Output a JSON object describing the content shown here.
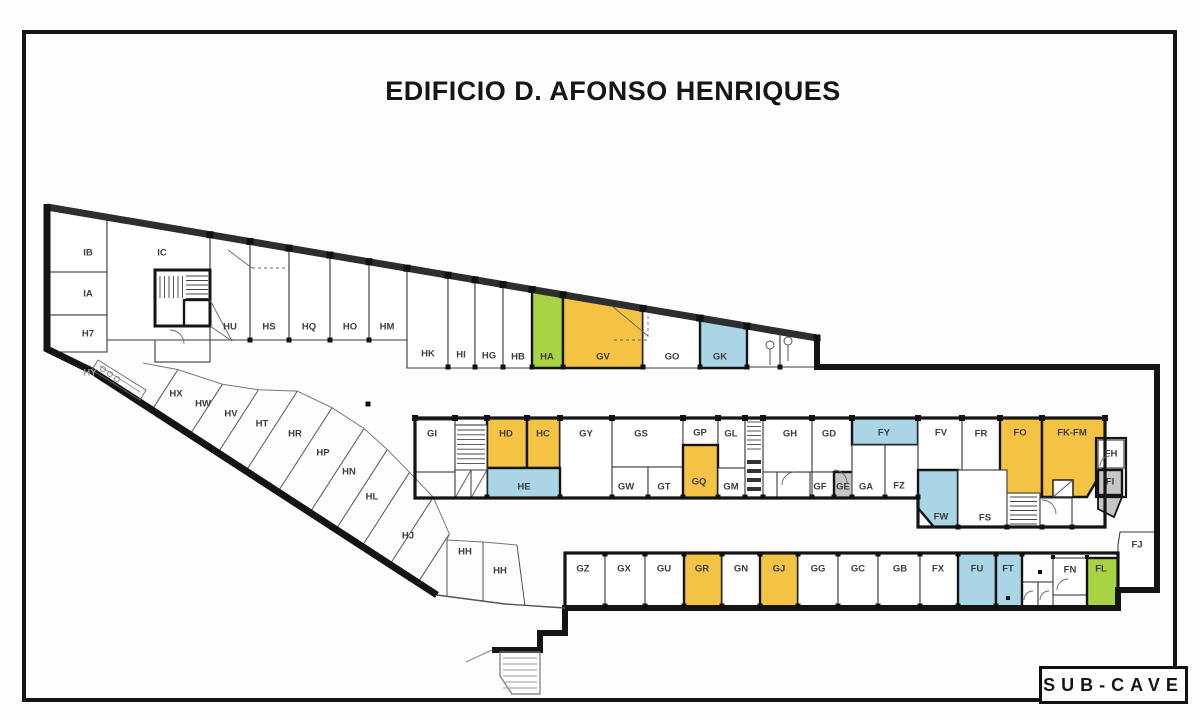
{
  "title": "EDIFICIO D. AFONSO HENRIQUES",
  "floor_label": "SUB-CAVE",
  "colors": {
    "orange": "#F4C343",
    "blue": "#A9D5E6",
    "green": "#A8D343",
    "gray": "#C6C6C6",
    "white": "#FFFFFF",
    "wall": "#151515"
  },
  "rooms": [
    {
      "id": "IB",
      "label": "IB",
      "color": "white"
    },
    {
      "id": "IA",
      "label": "IA",
      "color": "white"
    },
    {
      "id": "H7",
      "label": "H7",
      "color": "white"
    },
    {
      "id": "HY",
      "label": "HY",
      "color": "white"
    },
    {
      "id": "IC",
      "label": "IC",
      "color": "white"
    },
    {
      "id": "HU",
      "label": "HU",
      "color": "white"
    },
    {
      "id": "HS",
      "label": "HS",
      "color": "white"
    },
    {
      "id": "HQ",
      "label": "HQ",
      "color": "white"
    },
    {
      "id": "HO",
      "label": "HO",
      "color": "white"
    },
    {
      "id": "HM",
      "label": "HM",
      "color": "white"
    },
    {
      "id": "HK",
      "label": "HK",
      "color": "white"
    },
    {
      "id": "HI",
      "label": "HI",
      "color": "white"
    },
    {
      "id": "HG",
      "label": "HG",
      "color": "white"
    },
    {
      "id": "HB",
      "label": "HB",
      "color": "white"
    },
    {
      "id": "HA",
      "label": "HA",
      "color": "green"
    },
    {
      "id": "GV",
      "label": "GV",
      "color": "orange"
    },
    {
      "id": "GO",
      "label": "GO",
      "color": "white"
    },
    {
      "id": "GK",
      "label": "GK",
      "color": "blue"
    },
    {
      "id": "HX",
      "label": "HX",
      "color": "white"
    },
    {
      "id": "HW",
      "label": "HW",
      "color": "white"
    },
    {
      "id": "HV",
      "label": "HV",
      "color": "white"
    },
    {
      "id": "HT",
      "label": "HT",
      "color": "white"
    },
    {
      "id": "HR",
      "label": "HR",
      "color": "white"
    },
    {
      "id": "HP",
      "label": "HP",
      "color": "white"
    },
    {
      "id": "HN",
      "label": "HN",
      "color": "white"
    },
    {
      "id": "HL",
      "label": "HL",
      "color": "white"
    },
    {
      "id": "HJ",
      "label": "HJ",
      "color": "white"
    },
    {
      "id": "HH-1",
      "label": "HH",
      "color": "white"
    },
    {
      "id": "HH-2",
      "label": "HH",
      "color": "white"
    },
    {
      "id": "GI",
      "label": "GI",
      "color": "white"
    },
    {
      "id": "HD",
      "label": "HD",
      "color": "orange"
    },
    {
      "id": "HC",
      "label": "HC",
      "color": "orange"
    },
    {
      "id": "GY",
      "label": "GY",
      "color": "white"
    },
    {
      "id": "GS",
      "label": "GS",
      "color": "white"
    },
    {
      "id": "GP",
      "label": "GP",
      "color": "white"
    },
    {
      "id": "GL",
      "label": "GL",
      "color": "white"
    },
    {
      "id": "GH",
      "label": "GH",
      "color": "white"
    },
    {
      "id": "GD",
      "label": "GD",
      "color": "white"
    },
    {
      "id": "FY",
      "label": "FY",
      "color": "blue"
    },
    {
      "id": "FV",
      "label": "FV",
      "color": "white"
    },
    {
      "id": "FR",
      "label": "FR",
      "color": "white"
    },
    {
      "id": "FO",
      "label": "FO",
      "color": "orange"
    },
    {
      "id": "FK-FM",
      "label": "FK-FM",
      "color": "orange"
    },
    {
      "id": "FH",
      "label": "FH",
      "color": "white"
    },
    {
      "id": "FI",
      "label": "FI",
      "color": "gray"
    },
    {
      "id": "HE",
      "label": "HE",
      "color": "blue"
    },
    {
      "id": "GW",
      "label": "GW",
      "color": "white"
    },
    {
      "id": "GT",
      "label": "GT",
      "color": "white"
    },
    {
      "id": "GQ",
      "label": "GQ",
      "color": "orange"
    },
    {
      "id": "GM",
      "label": "GM",
      "color": "white"
    },
    {
      "id": "GF",
      "label": "GF",
      "color": "white"
    },
    {
      "id": "GE",
      "label": "GE",
      "color": "gray"
    },
    {
      "id": "GA",
      "label": "GA",
      "color": "white"
    },
    {
      "id": "FZ",
      "label": "FZ",
      "color": "white"
    },
    {
      "id": "FW",
      "label": "FW",
      "color": "blue"
    },
    {
      "id": "FS",
      "label": "FS",
      "color": "white"
    },
    {
      "id": "GZ",
      "label": "GZ",
      "color": "white"
    },
    {
      "id": "GX",
      "label": "GX",
      "color": "white"
    },
    {
      "id": "GU",
      "label": "GU",
      "color": "white"
    },
    {
      "id": "GR",
      "label": "GR",
      "color": "orange"
    },
    {
      "id": "GN",
      "label": "GN",
      "color": "white"
    },
    {
      "id": "GJ",
      "label": "GJ",
      "color": "orange"
    },
    {
      "id": "GG",
      "label": "GG",
      "color": "white"
    },
    {
      "id": "GC",
      "label": "GC",
      "color": "white"
    },
    {
      "id": "GB",
      "label": "GB",
      "color": "white"
    },
    {
      "id": "FX",
      "label": "FX",
      "color": "white"
    },
    {
      "id": "FU",
      "label": "FU",
      "color": "blue"
    },
    {
      "id": "FT",
      "label": "FT",
      "color": "blue"
    },
    {
      "id": "FN",
      "label": "FN",
      "color": "white"
    },
    {
      "id": "FL",
      "label": "FL",
      "color": "green"
    },
    {
      "id": "FJ",
      "label": "FJ",
      "color": "white"
    }
  ]
}
